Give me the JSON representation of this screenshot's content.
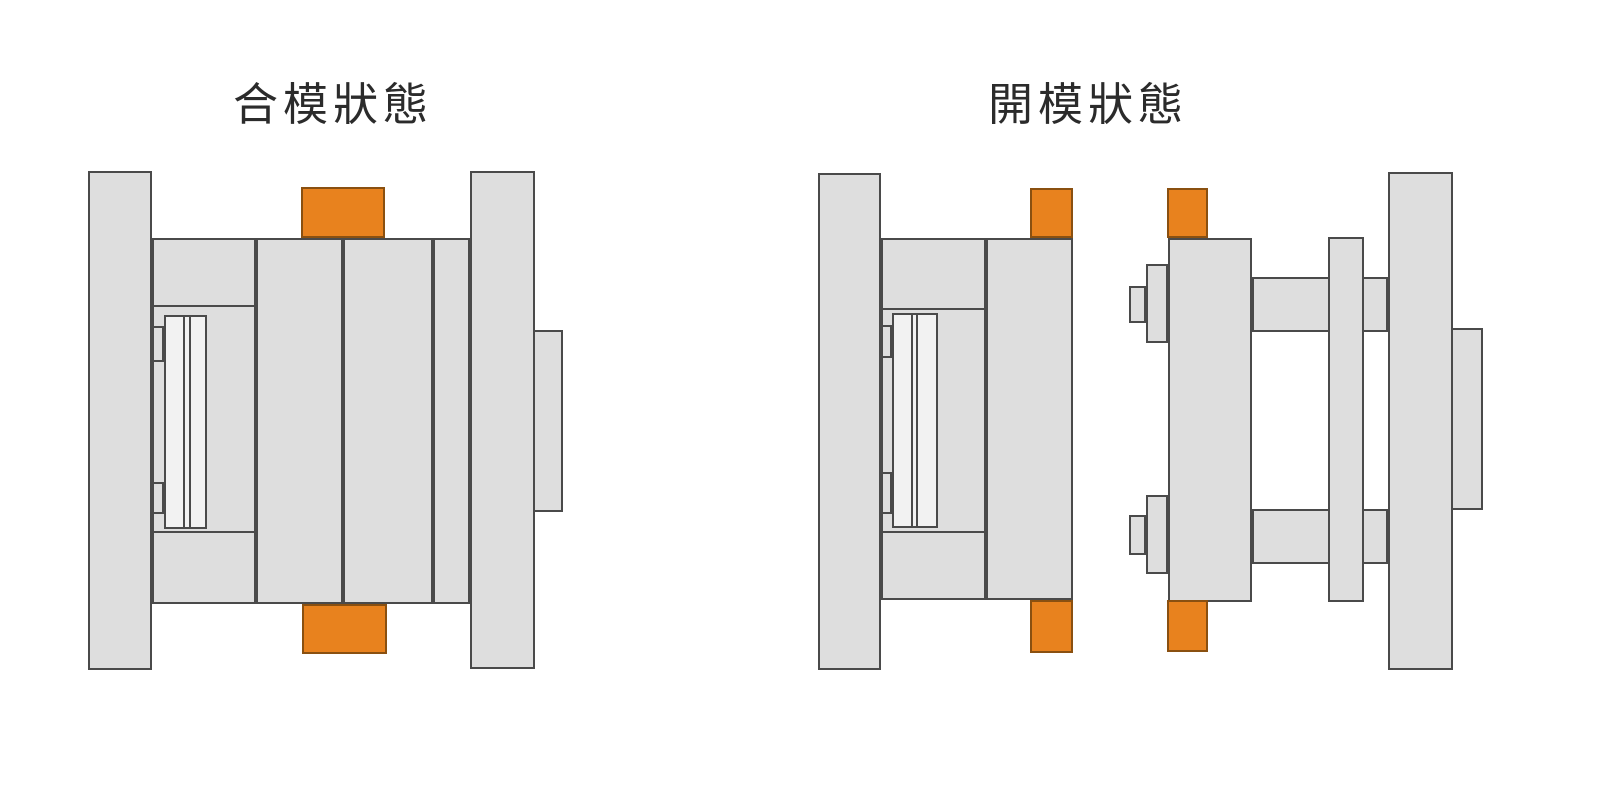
{
  "canvas": {
    "width": 1600,
    "height": 785,
    "background": "#ffffff"
  },
  "colors": {
    "part_fill": "#dedede",
    "part_fill_light": "#f2f2f2",
    "outline": "#4a4a4a",
    "accent_orange": "#e8821e",
    "accent_orange_outline": "#8a5010",
    "title_color": "#2b2b2b"
  },
  "figures": [
    {
      "id": "closed",
      "title": "合模狀態",
      "parts": [
        "movable-side-clamping-plate",
        "ejector-housing",
        "ejector-plate-assembly",
        "return-pin-stubs",
        "core-plate-b",
        "cavity-plate-a",
        "support-plate",
        "fixed-side-clamping-plate",
        "locating-block",
        "latch-block-top",
        "latch-block-bottom"
      ]
    },
    {
      "id": "open",
      "title": "開模狀態",
      "parts": [
        "movable-side-clamping-plate",
        "ejector-housing",
        "ejector-plate-assembly",
        "return-pin-stubs",
        "core-plate-b",
        "latch-block-top-moving",
        "latch-block-bottom-moving",
        "cavity-plate-a",
        "puller-bolt-top",
        "puller-bolt-bottom",
        "support-rod-top",
        "support-rod-bottom",
        "runner-stripper-plate",
        "fixed-side-clamping-plate",
        "locating-block",
        "latch-block-top-fixed",
        "latch-block-bottom-fixed"
      ]
    }
  ]
}
